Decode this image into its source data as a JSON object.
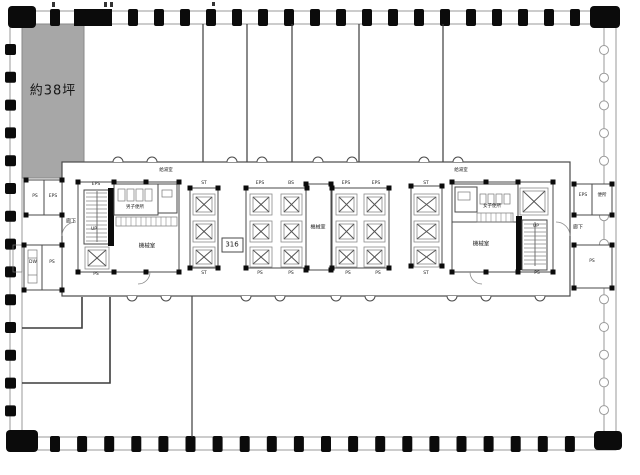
{
  "colors": {
    "area_fill": "#a7a7a7",
    "column_black": "#0b0b0b",
    "wall_gray": "#9a9a9a",
    "line_dark": "#4a4a4a",
    "text": "#222222"
  },
  "plan": {
    "area_label": "約38坪",
    "room_number": "316",
    "labels": {
      "ps": "PS",
      "eps": "EPS",
      "st": "ST",
      "bs": "BS",
      "dw": "DW",
      "up": "UP",
      "corridor": "廊下",
      "machine_room": "機械室",
      "mens_toilet": "男子便所",
      "womens_toilet": "女子便所",
      "kitchenette": "給湯室",
      "toilet": "便所"
    }
  }
}
